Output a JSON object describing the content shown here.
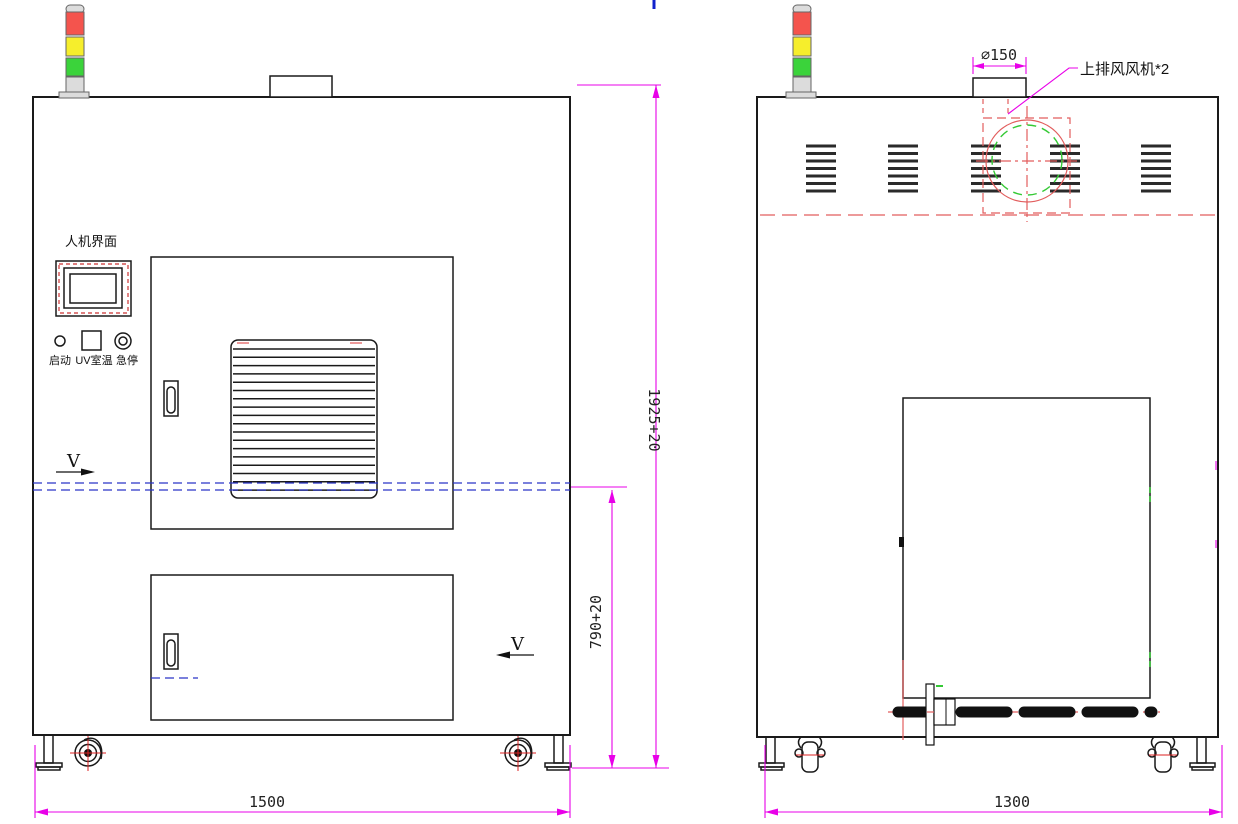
{
  "drawing": {
    "front_view": {
      "hmi_title": "人机界面",
      "buttons": {
        "start": "启动",
        "uv_temp": "UV室温",
        "estop": "急停"
      },
      "section_label_left": "V",
      "section_label_right": "V",
      "dim_width": "1500",
      "dim_overall_height": "1925+20",
      "dim_conveyor_height": "790+20"
    },
    "side_view": {
      "dim_width": "1300",
      "dim_duct_diameter": "⌀150",
      "fan_callout": "上排风风机*2"
    },
    "signal_tower": {
      "segments": [
        "red",
        "yellow",
        "green"
      ]
    },
    "colors": {
      "outline": "#1a1a1a",
      "dimension": "#e800e8",
      "hidden_red": "#e25d5d",
      "hidden_blue": "#2a35c8",
      "fan_green": "#35c935",
      "tower_red": "#f4544d",
      "tower_yellow": "#f6ee2c",
      "tower_green": "#3bd33b",
      "dim_text": "#222222"
    }
  }
}
